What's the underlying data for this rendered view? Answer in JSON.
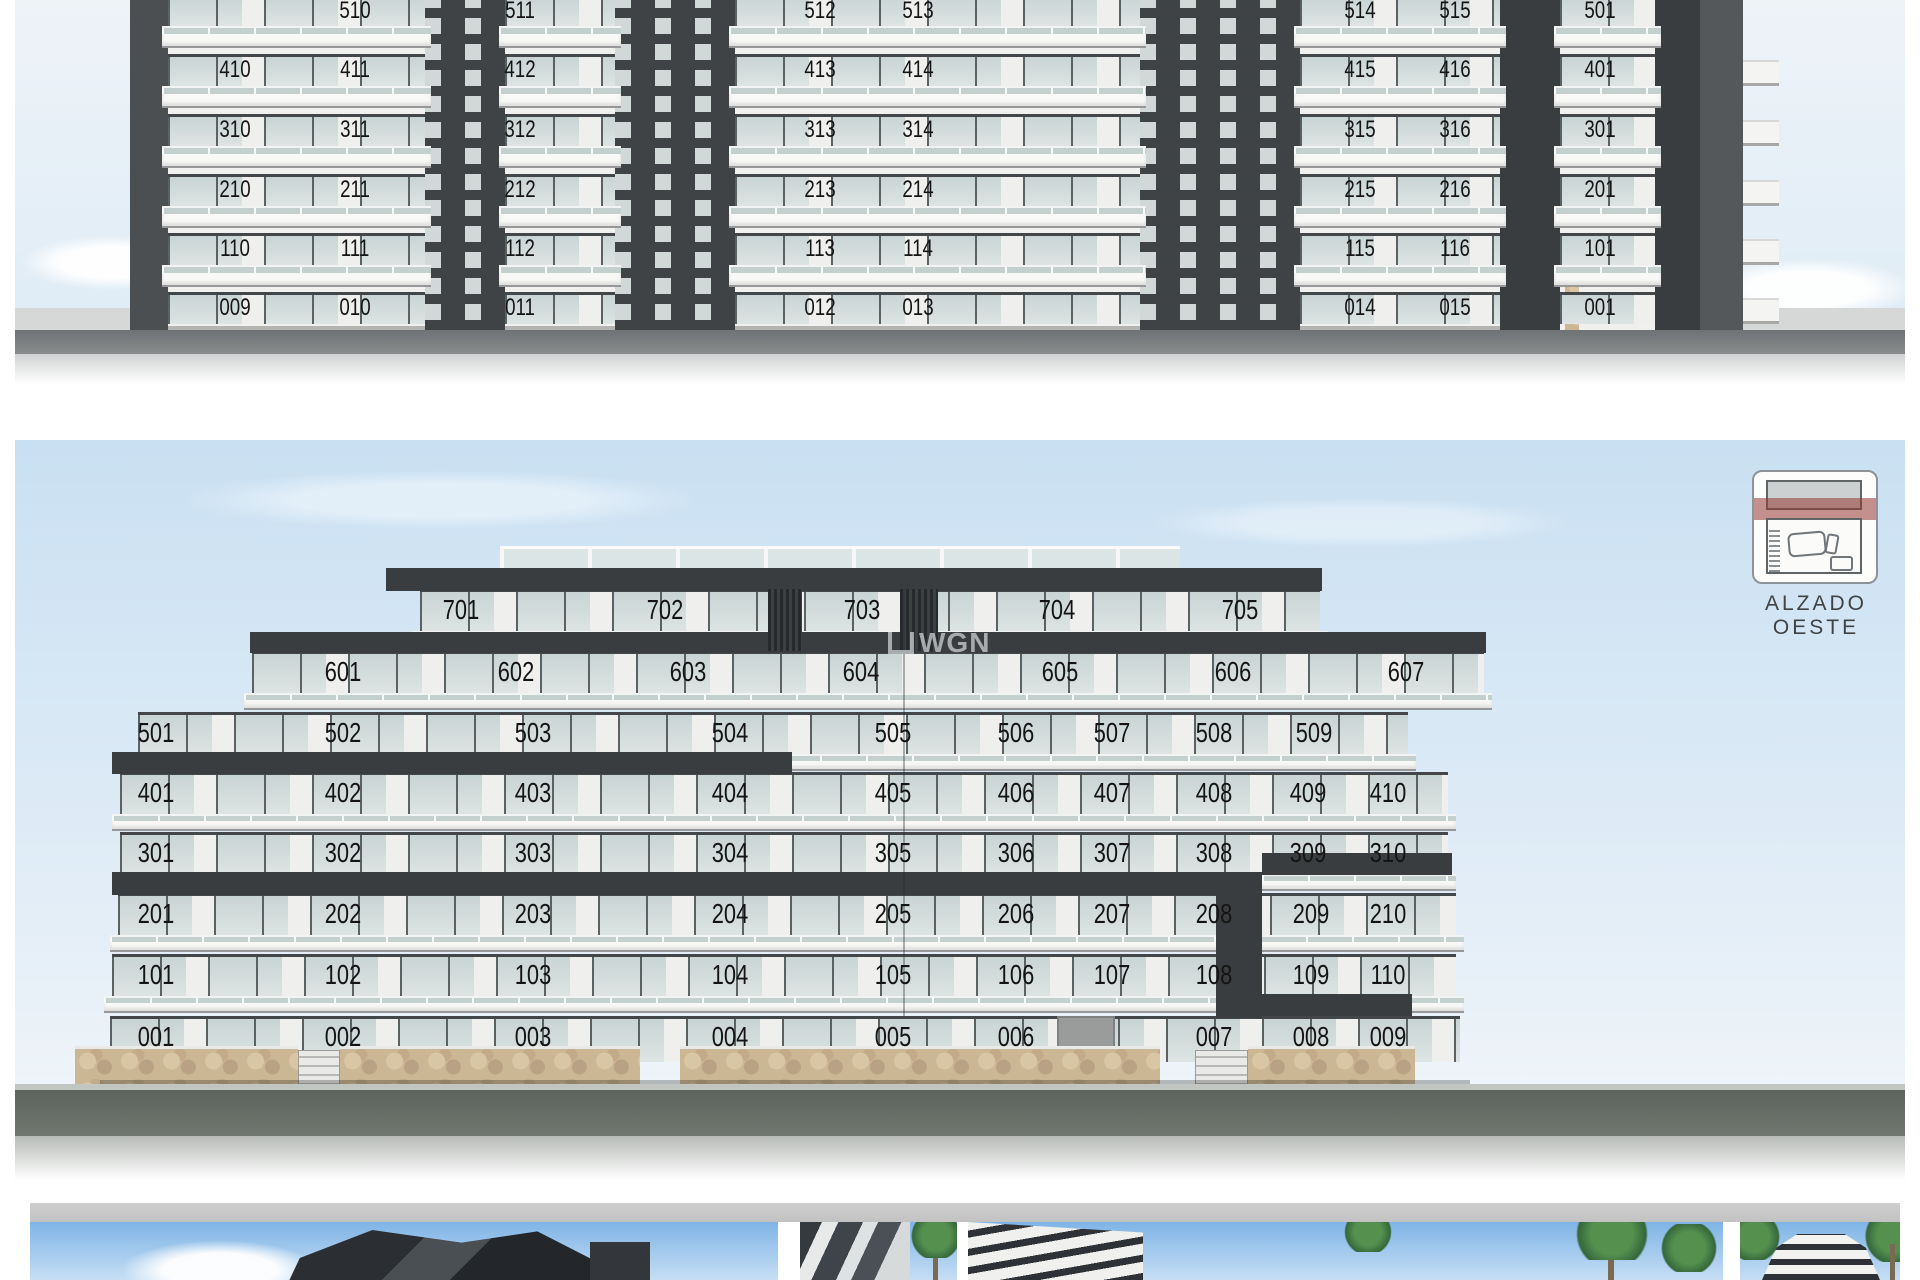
{
  "sheet": {
    "kind": "architectural elevation sheet",
    "west_elevation_label": "ALZADO OESTE"
  },
  "panel_top": {
    "name": "upper elevation (cropped at top of page)",
    "rows": [
      {
        "units": [
          "510",
          "511",
          "512",
          "513",
          "514",
          "515",
          "501"
        ]
      },
      {
        "units": [
          "410",
          "411",
          "412",
          "413",
          "414",
          "415",
          "416",
          "401"
        ]
      },
      {
        "units": [
          "310",
          "311",
          "312",
          "313",
          "314",
          "315",
          "316",
          "301"
        ]
      },
      {
        "units": [
          "210",
          "211",
          "212",
          "213",
          "214",
          "215",
          "216",
          "201"
        ]
      },
      {
        "units": [
          "110",
          "111",
          "112",
          "113",
          "114",
          "115",
          "116",
          "101"
        ]
      },
      {
        "units": [
          "009",
          "010",
          "011",
          "012",
          "013",
          "014",
          "015",
          "001"
        ]
      }
    ]
  },
  "panel_west": {
    "label": "ALZADO OESTE",
    "rows": [
      {
        "units": [
          "701",
          "702",
          "703",
          "704",
          "705"
        ]
      },
      {
        "units": [
          "601",
          "602",
          "603",
          "604",
          "605",
          "606",
          "607"
        ]
      },
      {
        "units": [
          "501",
          "502",
          "503",
          "504",
          "505",
          "506",
          "507",
          "508",
          "509"
        ]
      },
      {
        "units": [
          "401",
          "402",
          "403",
          "404",
          "405",
          "406",
          "407",
          "408",
          "409",
          "410"
        ]
      },
      {
        "units": [
          "301",
          "302",
          "303",
          "304",
          "305",
          "306",
          "307",
          "308",
          "309",
          "310"
        ]
      },
      {
        "units": [
          "201",
          "202",
          "203",
          "204",
          "205",
          "206",
          "207",
          "208",
          "209",
          "210"
        ]
      },
      {
        "units": [
          "101",
          "102",
          "103",
          "104",
          "105",
          "106",
          "107",
          "108",
          "109",
          "110"
        ]
      },
      {
        "units": [
          "001",
          "002",
          "003",
          "004",
          "005",
          "006",
          "007",
          "008",
          "009"
        ]
      }
    ]
  },
  "watermark": {
    "text": "WGN"
  },
  "icons": {
    "site_plan": "site-plan-icon"
  },
  "colors": {
    "sky_top_panel": "#e9f1f8",
    "sky_west_panel": "#cadef1",
    "charcoal_band": "#3a3d3f",
    "stone_wall": "#ccb795",
    "elevation_highlight_red": "rgba(150,55,50,0.55)",
    "ground": "#5d645d",
    "gray_bar": "#c7c7c7"
  },
  "thumbnails": [
    {
      "name": "building-render-thumbnail-1"
    },
    {
      "name": "building-render-thumbnail-2"
    },
    {
      "name": "building-render-thumbnail-3"
    },
    {
      "name": "building-render-thumbnail-4"
    }
  ]
}
